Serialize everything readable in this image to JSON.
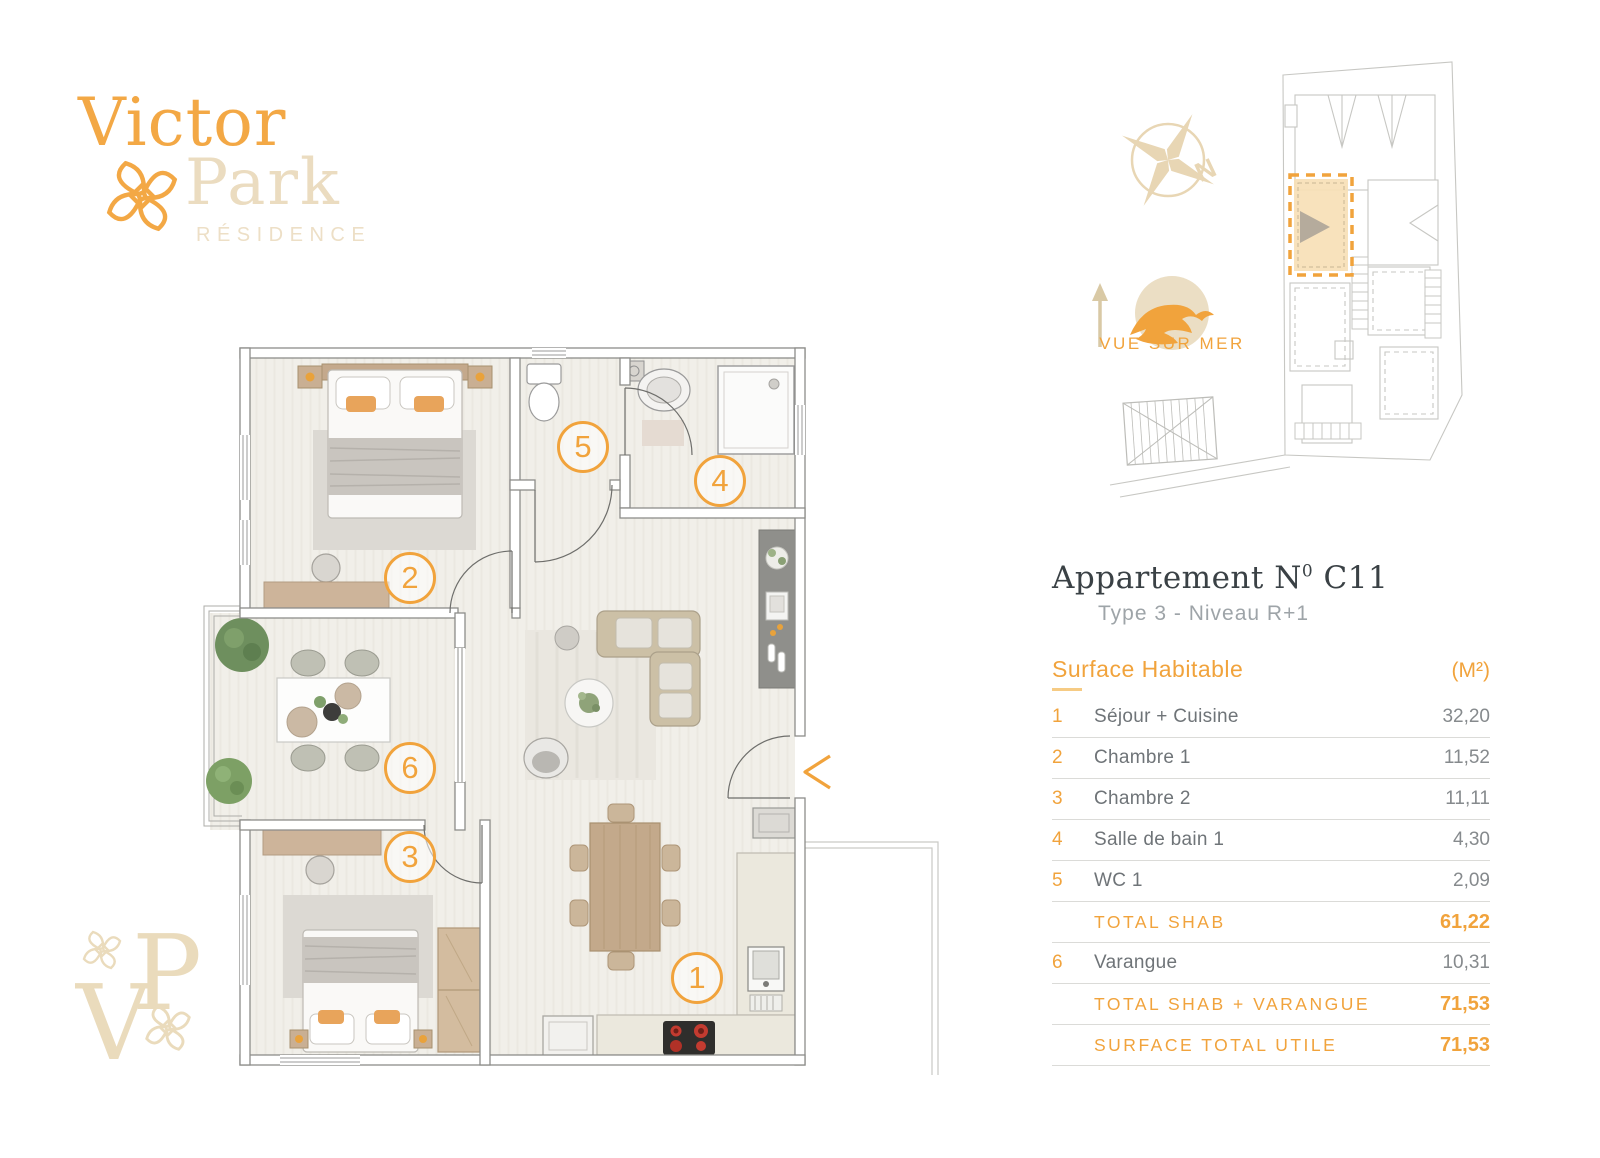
{
  "brand": {
    "word1": "Victor",
    "word2": "Park",
    "word3": "RÉSIDENCE",
    "monogram_v": "V",
    "monogram_p": "P"
  },
  "siteplan": {
    "north_label": "N",
    "view_label": "VUE SUR MER"
  },
  "apartment": {
    "label": "Appartement",
    "number_letter": "N",
    "number_sup": "0",
    "number": "C11",
    "subtitle": "Type 3 - Niveau R+1"
  },
  "surface": {
    "header": "Surface Habitable",
    "unit": "(M²)",
    "rows": [
      {
        "num": "1",
        "label": "Séjour + Cuisine",
        "value": "32,20"
      },
      {
        "num": "2",
        "label": "Chambre 1",
        "value": "11,52"
      },
      {
        "num": "3",
        "label": "Chambre 2",
        "value": "11,11"
      },
      {
        "num": "4",
        "label": "Salle de bain 1",
        "value": "4,30"
      },
      {
        "num": "5",
        "label": "WC 1",
        "value": "2,09"
      },
      {
        "num": "",
        "label": "TOTAL SHAB",
        "value": "61,22"
      },
      {
        "num": "6",
        "label": "Varangue",
        "value": "10,31"
      },
      {
        "num": "",
        "label": "TOTAL SHAB + VARANGUE",
        "value": "71,53"
      },
      {
        "num": "",
        "label": "SURFACE TOTAL UTILE",
        "value": "71,53"
      }
    ]
  },
  "floorplan": {
    "badges": [
      "1",
      "2",
      "3",
      "4",
      "5",
      "6"
    ]
  },
  "colors": {
    "accent": "#F1A33C",
    "brand_beige": "#EADBBC"
  }
}
